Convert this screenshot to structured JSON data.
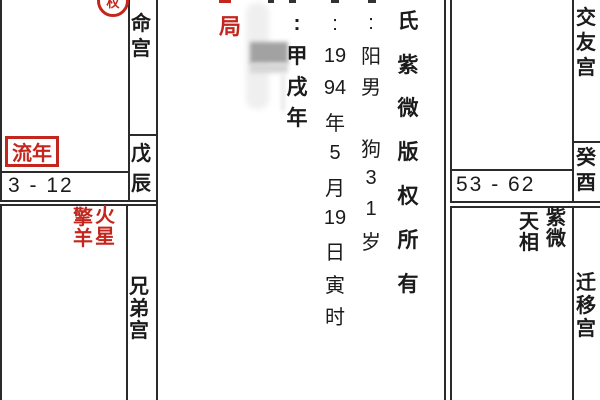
{
  "colors": {
    "red": "#c3261d",
    "ink": "#1b1b1b",
    "border": "#2b2b2b"
  },
  "marker": {
    "char": "权"
  },
  "palaces": {
    "life": {
      "name": [
        "命",
        "宫"
      ],
      "stem": [
        "戊",
        "辰"
      ],
      "flow_year_label": "流年",
      "age_range": "3 - 12"
    },
    "siblings": {
      "name": [
        "兄",
        "弟",
        "宫"
      ],
      "star_a": [
        "擎",
        "羊"
      ],
      "star_b": [
        "火",
        "星"
      ]
    },
    "friends": {
      "name": [
        "交",
        "友",
        "宫"
      ],
      "stem": [
        "癸",
        "酉"
      ],
      "age_range": "53 - 62"
    },
    "migration": {
      "name": [
        "迁",
        "移",
        "宫"
      ],
      "star_a": [
        "天",
        "相"
      ],
      "star_b": [
        "紫",
        "微"
      ]
    }
  },
  "center": {
    "bureau": "局",
    "ganzhi_col": [
      ":",
      "甲",
      "戌",
      "年"
    ],
    "date_col": [
      ":",
      "19",
      "94",
      "年",
      "5",
      "月",
      "19",
      "日",
      "寅",
      "时"
    ],
    "gender_col": [
      ":",
      "阳",
      "男",
      "",
      "狗",
      "3",
      "1",
      "岁"
    ],
    "copyright_col": [
      "氏",
      "紫",
      "微",
      "版",
      "权",
      "所",
      "有"
    ]
  }
}
